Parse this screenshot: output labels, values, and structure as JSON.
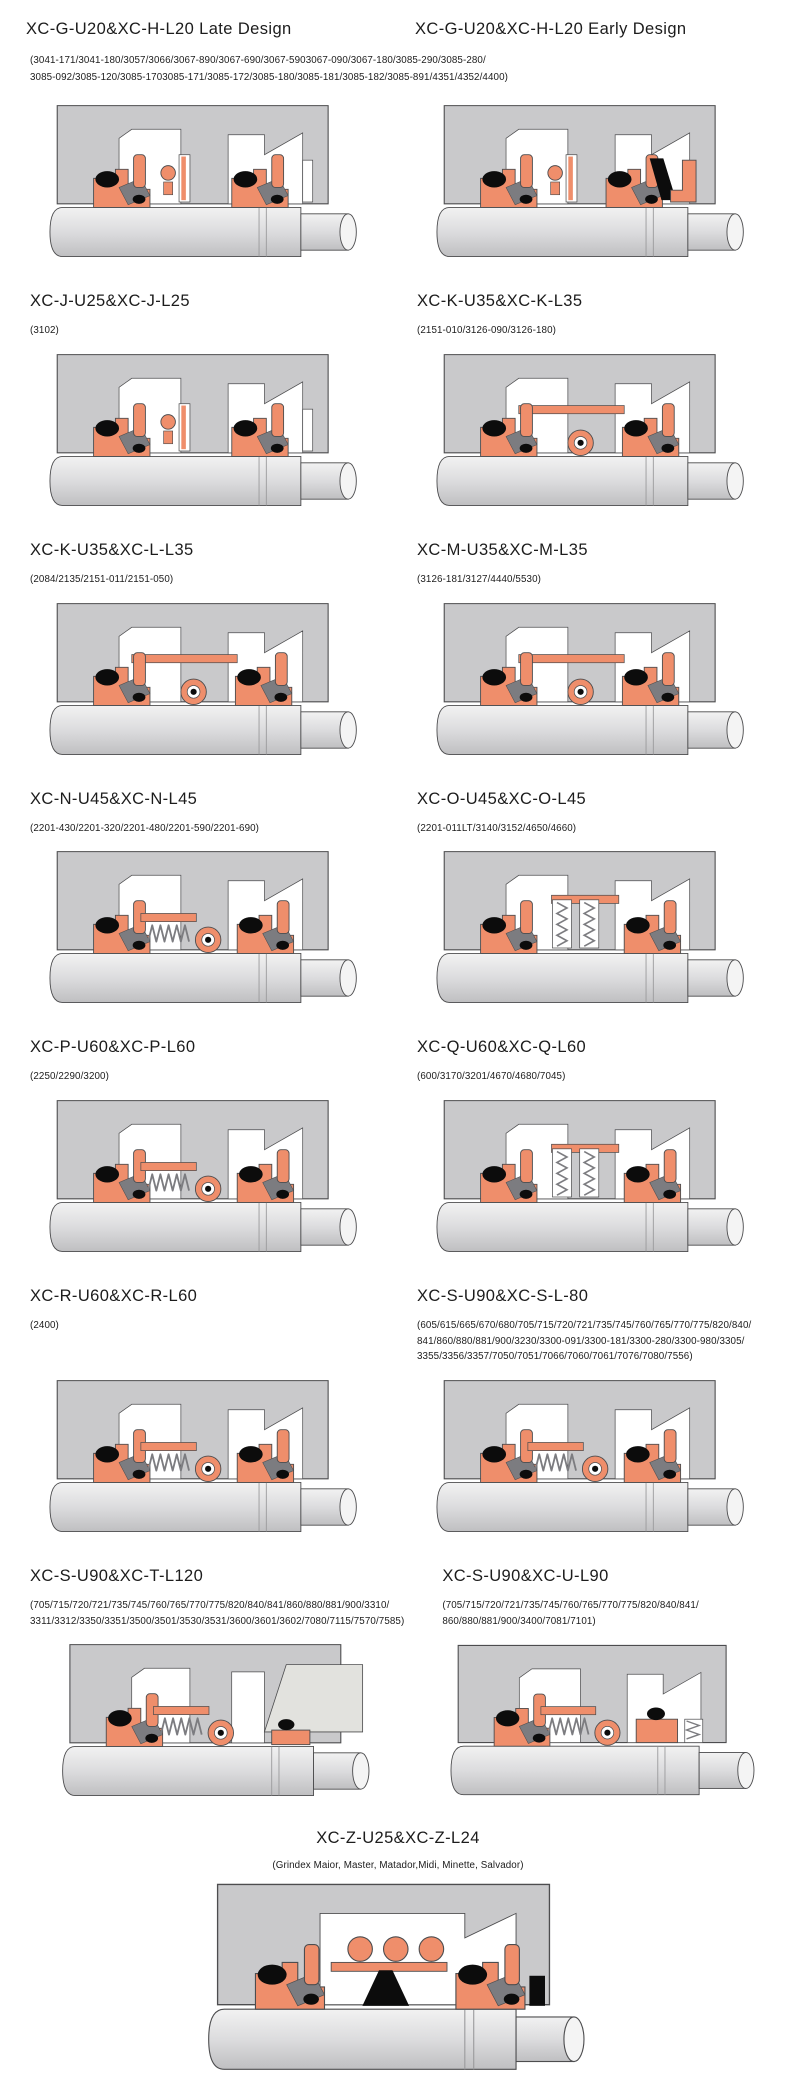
{
  "colors": {
    "background": "#ffffff",
    "housing": "#c9c9cb",
    "seal": "#ef8e6b",
    "dark": "#0c0c0c",
    "mid_gray": "#7c7c80",
    "outline": "#4d4d4f",
    "shaft_top": "#f2f2f2",
    "shaft_mid": "#dcdcde",
    "shaft_bottom": "#bfbfc1",
    "wedge_gray": "#e2e2de"
  },
  "header_row": {
    "titles": [
      "XC-G-U20&XC-H-L20 Late Design",
      "XC-G-U20&XC-H-L20 Early Design"
    ],
    "subtitle": "(3041-171/3041-180/3057/3066/3067-890/3067-690/3067-5903067-090/3067-180/3085-290/3085-280/\n3085-092/3085-120/3085-1703085-171/3085-172/3085-180/3085-181/3085-182/3085-891/4351/4352/4400)",
    "diagrams": [
      "seal-basic",
      "seal-black-wedge"
    ]
  },
  "panels": [
    {
      "title": "XC-J-U25&XC-J-L25",
      "subtitle": "(3102)",
      "diagram": "seal-basic"
    },
    {
      "title": "XC-K-U35&XC-K-L35",
      "subtitle": "(2151-010/3126-090/3126-180)",
      "diagram": "seal-donut"
    },
    {
      "title": "XC-K-U35&XC-L-L35",
      "subtitle": "(2084/2135/2151-011/2151-050)",
      "diagram": "seal-donut"
    },
    {
      "title": "XC-M-U35&XC-M-L35",
      "subtitle": "(3126-181/3127/4440/5530)",
      "diagram": "seal-donut"
    },
    {
      "title": "XC-N-U45&XC-N-L45",
      "subtitle": "(2201-430/2201-320/2201-480/2201-590/2201-690)",
      "diagram": "seal-coil-donut"
    },
    {
      "title": "XC-O-U45&XC-O-L45",
      "subtitle": "(2201-011LT/3140/3152/4650/4660)",
      "diagram": "seal-vertical-springs"
    },
    {
      "title": "XC-P-U60&XC-P-L60",
      "subtitle": "(2250/2290/3200)",
      "diagram": "seal-coil-donut"
    },
    {
      "title": "XC-Q-U60&XC-Q-L60",
      "subtitle": "(600/3170/3201/4670/4680/7045)",
      "diagram": "seal-vertical-springs"
    },
    {
      "title": "XC-R-U60&XC-R-L60",
      "subtitle": "(2400)",
      "diagram": "seal-coil-donut"
    },
    {
      "title": "XC-S-U90&XC-S-L-80",
      "subtitle": "(605/615/665/670/680/705/715/720/721/735/745/760/765/770/775/820/840/\n841/860/880/881/900/3230/3300-091/3300-181/3300-280/3300-980/3305/\n3355/3356/3357/7050/7051/7066/7060/7061/7076/7080/7556)",
      "diagram": "seal-coil-donut"
    },
    {
      "title": "XC-S-U90&XC-T-L120",
      "subtitle": "(705/715/720/721/735/745/760/765/770/775/820/840/841/860/880/881/900/3310/\n3311/3312/3350/3351/3500/3501/3530/3531/3600/3601/3602/7080/7115/7570/7585)",
      "diagram": "seal-coil-wedge"
    },
    {
      "title": "XC-S-U90&XC-U-L90",
      "subtitle": "(705/715/720/721/735/745/760/765/770/775/820/840/841/\n860/880/881/900/3400/7081/7101)",
      "diagram": "seal-coil-compact"
    }
  ],
  "footer_panel": {
    "title": "XC-Z-U25&XC-Z-L24",
    "subtitle": "(Grindex  Maior, Master, Matador,Midi, Minette, Salvador)",
    "diagram": "seal-spring-row"
  }
}
